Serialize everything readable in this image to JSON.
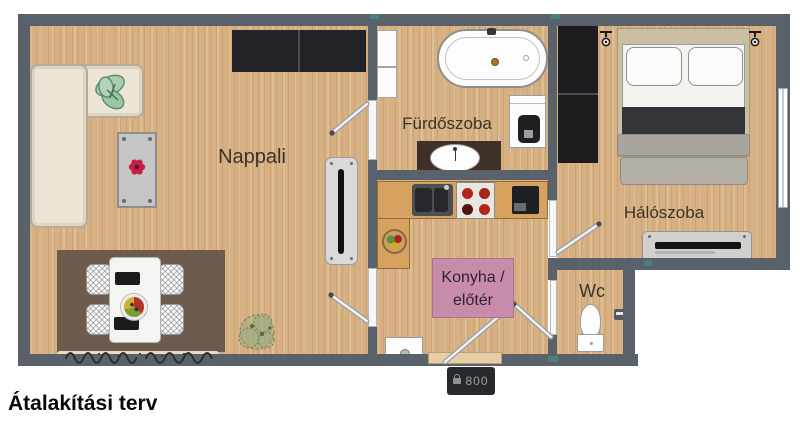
{
  "title": "Átalakítási terv",
  "rooms": {
    "living": {
      "label": "Nappali"
    },
    "bathroom": {
      "label": "Fürdőszoba"
    },
    "kitchen_hall": {
      "label_line1": "Konyha /",
      "label_line2": "előtér"
    },
    "bedroom": {
      "label": "Hálószoba"
    },
    "wc": {
      "label": "Wc"
    }
  },
  "entrance": {
    "width_label": "800"
  },
  "colors": {
    "wall": "#59626b",
    "floor": "#d7b083",
    "kitchen_counter": "#d7a160",
    "kitchen_label_bg": "#c88cab",
    "dining_rug": "#6d5b4d",
    "wardrobe": "#212326",
    "flower_accent": "#c22048"
  }
}
